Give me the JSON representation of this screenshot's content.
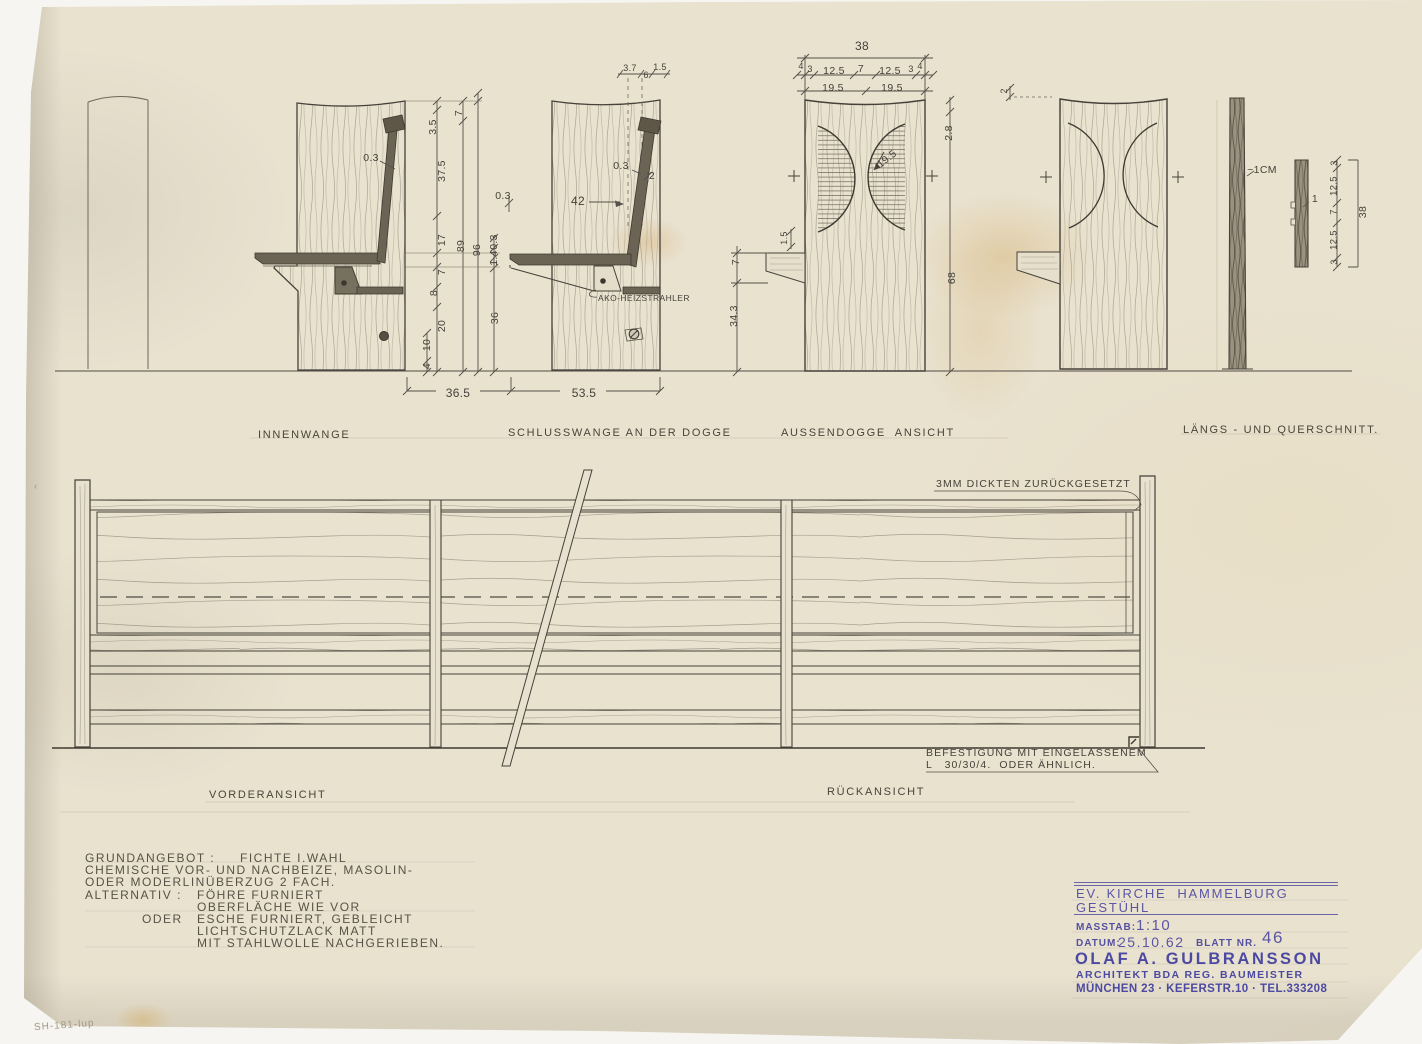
{
  "title_block": {
    "project_line1": "EV. KIRCHE  HAMMELBURG",
    "project_line2": "GESTÜHL",
    "scale_label": "MASSTAB:",
    "scale_value": "1:10",
    "date_label": "DATUM:",
    "date_value": "25.10.62",
    "sheet_label": "BLATT NR.",
    "sheet_value": "46",
    "architect_name": "OLAF A. GULBRANSSON",
    "architect_title": "ARCHITEKT BDA REG. BAUMEISTER",
    "architect_address": "MÜNCHEN 23 · KEFERSTR.10 · TEL.333208"
  },
  "texts": [
    {
      "t": "INNENWANGE",
      "x": 258,
      "y": 429,
      "c": "caption",
      "n": "caption-innenwange"
    },
    {
      "t": "SCHLUSSWANGE AN DER DOGGE",
      "x": 508,
      "y": 427,
      "c": "caption",
      "n": "caption-schlusswange"
    },
    {
      "t": "AUSSENDOGGE  ANSICHT",
      "x": 781,
      "y": 427,
      "c": "caption",
      "n": "caption-aussendogge"
    },
    {
      "t": "LÄNGS - UND QUERSCHNITT.",
      "x": 1183,
      "y": 424,
      "c": "caption",
      "n": "caption-schnitt"
    },
    {
      "t": "VORDERANSICHT",
      "x": 209,
      "y": 789,
      "c": "caption",
      "n": "caption-vorderansicht"
    },
    {
      "t": "RÜCKANSICHT",
      "x": 827,
      "y": 786,
      "c": "caption",
      "n": "caption-rueckansicht"
    },
    {
      "t": "3MM DICKTEN ZURÜCKGESETZT",
      "x": 936,
      "y": 478,
      "c": "note",
      "n": "note-setback"
    },
    {
      "t": "BEFESTIGUNG MIT EINGELASSENEM",
      "x": 926,
      "y": 747,
      "c": "note",
      "n": "note-mounting-1"
    },
    {
      "t": "L   30/30/4.  ODER ÄHNLICH.",
      "x": 926,
      "y": 759,
      "c": "note",
      "n": "note-mounting-2"
    },
    {
      "t": "AKO-HEIZSTRAHLER",
      "x": 598,
      "y": 293,
      "c": "tiny",
      "n": "label-heater"
    },
    {
      "t": "GRUNDANGEBOT :",
      "x": 85,
      "y": 851,
      "c": "spec",
      "n": "spec-line"
    },
    {
      "t": "FICHTE I.WAHL",
      "x": 240,
      "y": 851,
      "c": "spec",
      "n": "spec-line"
    },
    {
      "t": "CHEMISCHE VOR- UND NACHBEIZE, MASOLIN-",
      "x": 85,
      "y": 863,
      "c": "spec",
      "n": "spec-line"
    },
    {
      "t": "ODER MODERLINÜBERZUG 2 FACH.",
      "x": 85,
      "y": 875,
      "c": "spec",
      "n": "spec-line"
    },
    {
      "t": "ALTERNATIV :",
      "x": 85,
      "y": 888,
      "c": "spec",
      "n": "spec-line"
    },
    {
      "t": "FÖHRE FURNIERT",
      "x": 197,
      "y": 888,
      "c": "spec",
      "n": "spec-line"
    },
    {
      "t": "OBERFLÄCHE WIE VOR",
      "x": 197,
      "y": 900,
      "c": "spec",
      "n": "spec-line"
    },
    {
      "t": "ODER",
      "x": 142,
      "y": 912,
      "c": "spec",
      "n": "spec-line"
    },
    {
      "t": "ESCHE FURNIERT, GEBLEICHT",
      "x": 197,
      "y": 912,
      "c": "spec",
      "n": "spec-line"
    },
    {
      "t": "LICHTSCHUTZLACK MATT",
      "x": 197,
      "y": 924,
      "c": "spec",
      "n": "spec-line"
    },
    {
      "t": "MIT STAHLWOLLE NACHGERIEBEN.",
      "x": 197,
      "y": 936,
      "c": "spec",
      "n": "spec-line"
    },
    {
      "t": "SH-181-lup",
      "x": 34,
      "y": 1020,
      "c": "pencil",
      "r": -4,
      "n": "pencil-code"
    },
    {
      "t": "‹",
      "x": 34,
      "y": 481,
      "c": "pencil",
      "n": "pencil-mark"
    }
  ],
  "dims": [
    {
      "t": "0.3",
      "x": 371,
      "y": 158
    },
    {
      "t": "3.5",
      "x": 433,
      "y": 127,
      "r": -90
    },
    {
      "t": "7",
      "x": 459,
      "y": 113,
      "r": -90
    },
    {
      "t": "37.5",
      "x": 442,
      "y": 171,
      "r": -90
    },
    {
      "t": "17",
      "x": 442,
      "y": 240,
      "r": -90
    },
    {
      "t": "89",
      "x": 461,
      "y": 246,
      "r": -90
    },
    {
      "t": "96",
      "x": 477,
      "y": 250,
      "r": -90
    },
    {
      "t": "7",
      "x": 442,
      "y": 272,
      "r": -90
    },
    {
      "t": "8",
      "x": 434,
      "y": 293,
      "r": -90
    },
    {
      "t": "20",
      "x": 442,
      "y": 326,
      "r": -90
    },
    {
      "t": "10",
      "x": 427,
      "y": 345,
      "r": -90
    },
    {
      "t": "4",
      "x": 427,
      "y": 366,
      "r": -90
    },
    {
      "t": "0.3",
      "x": 494,
      "y": 242,
      "r": -90
    },
    {
      "t": "1.4",
      "x": 494,
      "y": 258,
      "r": -90
    },
    {
      "t": "36",
      "x": 495,
      "y": 318,
      "r": -90
    },
    {
      "t": "36.5",
      "x": 458,
      "y": 393,
      "s": 12
    },
    {
      "t": "0.3",
      "x": 503,
      "y": 196
    },
    {
      "t": "3.7",
      "x": 630,
      "y": 68,
      "s": 9
    },
    {
      "t": "6",
      "x": 646,
      "y": 75,
      "s": 9
    },
    {
      "t": "1.5",
      "x": 660,
      "y": 67,
      "s": 9
    },
    {
      "t": "0.3",
      "x": 621,
      "y": 166
    },
    {
      "t": "2",
      "x": 652,
      "y": 176
    },
    {
      "t": "42",
      "x": 578,
      "y": 201,
      "s": 12
    },
    {
      "t": "53.5",
      "x": 584,
      "y": 393,
      "s": 12
    },
    {
      "t": "7",
      "x": 736,
      "y": 262,
      "r": -90
    },
    {
      "t": "34.3",
      "x": 734,
      "y": 316,
      "r": -90
    },
    {
      "t": "38",
      "x": 862,
      "y": 46,
      "s": 12
    },
    {
      "t": "4",
      "x": 801,
      "y": 66,
      "s": 9
    },
    {
      "t": "3",
      "x": 810,
      "y": 69,
      "s": 9
    },
    {
      "t": "12.5",
      "x": 834,
      "y": 71
    },
    {
      "t": "7",
      "x": 861,
      "y": 69
    },
    {
      "t": "12.5",
      "x": 890,
      "y": 71
    },
    {
      "t": "3",
      "x": 911,
      "y": 69,
      "s": 9
    },
    {
      "t": "4",
      "x": 920,
      "y": 66,
      "s": 9
    },
    {
      "t": "19.5",
      "x": 833,
      "y": 88
    },
    {
      "t": "19.5",
      "x": 892,
      "y": 88
    },
    {
      "t": "19.5",
      "x": 887,
      "y": 159,
      "r": -38
    },
    {
      "t": "1.5",
      "x": 784,
      "y": 238,
      "r": -90,
      "s": 9
    },
    {
      "t": "2.8",
      "x": 949,
      "y": 133,
      "r": -90
    },
    {
      "t": "68",
      "x": 952,
      "y": 278,
      "r": -90
    },
    {
      "t": "2",
      "x": 1004,
      "y": 91,
      "r": -90,
      "s": 9
    },
    {
      "t": "~1CM",
      "x": 1262,
      "y": 170
    },
    {
      "t": "1",
      "x": 1315,
      "y": 199
    },
    {
      "t": "3",
      "x": 1334,
      "y": 163,
      "r": -90,
      "s": 9
    },
    {
      "t": "12.5",
      "x": 1334,
      "y": 186,
      "r": -90,
      "s": 9.5
    },
    {
      "t": "7",
      "x": 1334,
      "y": 212,
      "r": -90,
      "s": 9.5
    },
    {
      "t": "12.5",
      "x": 1334,
      "y": 240,
      "r": -90,
      "s": 9.5
    },
    {
      "t": "3",
      "x": 1334,
      "y": 262,
      "r": -90,
      "s": 9
    },
    {
      "t": "38",
      "x": 1363,
      "y": 212,
      "r": -90
    }
  ]
}
